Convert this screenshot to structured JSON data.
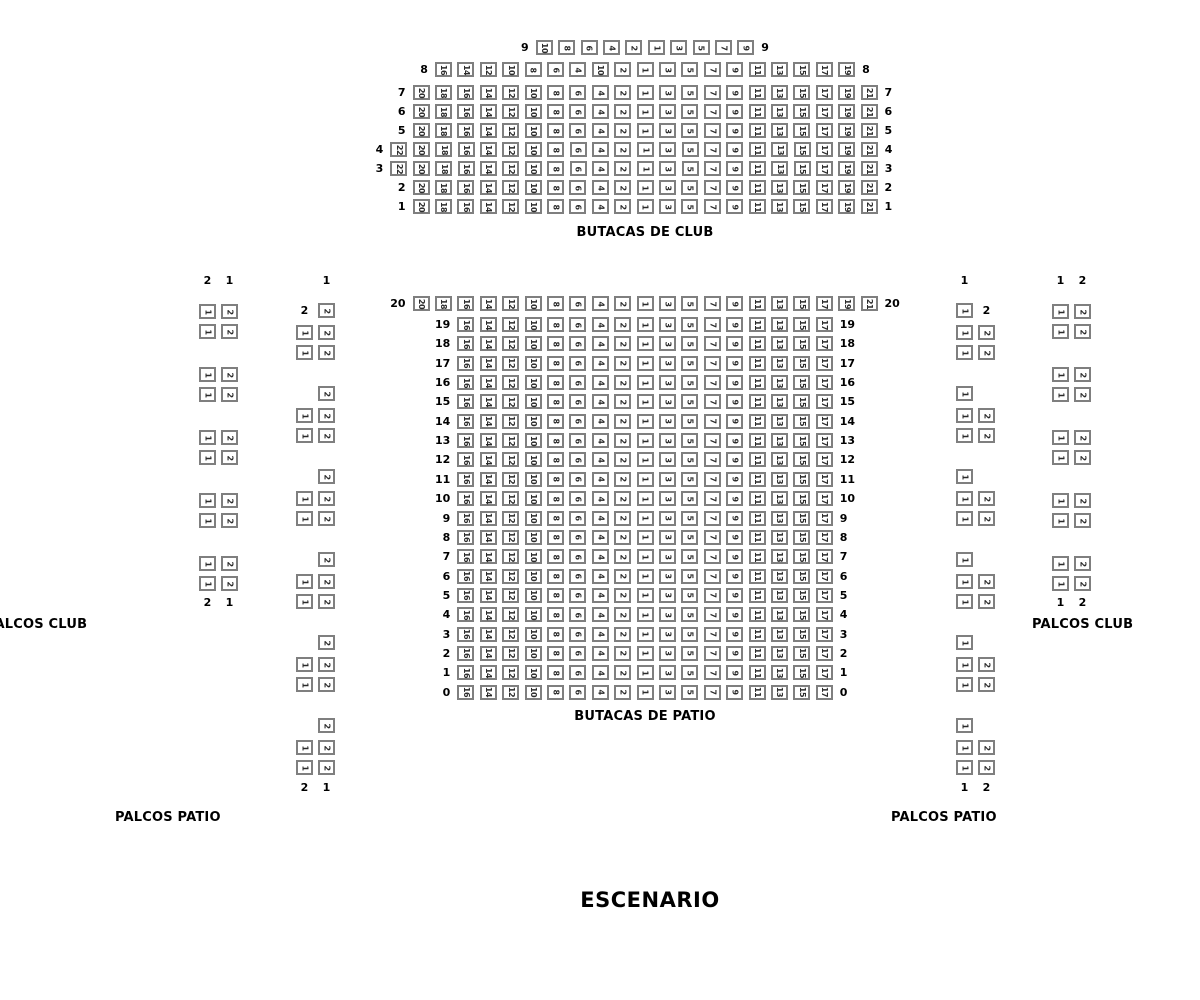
{
  "stage": {
    "label": "ESCENARIO"
  },
  "colors": {
    "seat_border": "#7f7f7f",
    "seat_number": "#2b2b2b",
    "label_text": "#000000"
  },
  "sections": {
    "club": {
      "title": "BUTACAS DE CLUB",
      "rows": [
        {
          "label": "9",
          "seats": [
            "10",
            "8",
            "6",
            "4",
            "2",
            "1",
            "3",
            "5",
            "7",
            "9"
          ]
        },
        {
          "label": "8",
          "seats": [
            "16",
            "14",
            "12",
            "10",
            "8",
            "6",
            "4",
            "10",
            "2",
            "1",
            "3",
            "5",
            "7",
            "9",
            "11",
            "13",
            "15",
            "17",
            "19"
          ]
        },
        {
          "label": "7",
          "seats": [
            "20",
            "18",
            "16",
            "14",
            "12",
            "10",
            "8",
            "6",
            "4",
            "2",
            "1",
            "3",
            "5",
            "7",
            "9",
            "11",
            "13",
            "15",
            "17",
            "19",
            "21"
          ]
        },
        {
          "label": "6",
          "seats": [
            "20",
            "18",
            "16",
            "14",
            "12",
            "10",
            "8",
            "6",
            "4",
            "2",
            "1",
            "3",
            "5",
            "7",
            "9",
            "11",
            "13",
            "15",
            "17",
            "19",
            "21"
          ]
        },
        {
          "label": "5",
          "seats": [
            "20",
            "18",
            "16",
            "14",
            "12",
            "10",
            "8",
            "6",
            "4",
            "2",
            "1",
            "3",
            "5",
            "7",
            "9",
            "11",
            "13",
            "15",
            "17",
            "19",
            "21"
          ]
        },
        {
          "label": "4",
          "seats": [
            "22",
            "20",
            "18",
            "16",
            "14",
            "12",
            "10",
            "8",
            "6",
            "4",
            "2",
            "1",
            "3",
            "5",
            "7",
            "9",
            "11",
            "13",
            "15",
            "17",
            "19",
            "21"
          ]
        },
        {
          "label": "3",
          "seats": [
            "22",
            "20",
            "18",
            "16",
            "14",
            "12",
            "10",
            "8",
            "6",
            "4",
            "2",
            "1",
            "3",
            "5",
            "7",
            "9",
            "11",
            "13",
            "15",
            "17",
            "19",
            "21"
          ]
        },
        {
          "label": "2",
          "seats": [
            "20",
            "18",
            "16",
            "14",
            "12",
            "10",
            "8",
            "6",
            "4",
            "2",
            "1",
            "3",
            "5",
            "7",
            "9",
            "11",
            "13",
            "15",
            "17",
            "19",
            "21"
          ]
        },
        {
          "label": "1",
          "seats": [
            "20",
            "18",
            "16",
            "14",
            "12",
            "10",
            "8",
            "6",
            "4",
            "2",
            "1",
            "3",
            "5",
            "7",
            "9",
            "11",
            "13",
            "15",
            "17",
            "19",
            "21"
          ]
        }
      ]
    },
    "patio": {
      "title": "BUTACAS DE PATIO",
      "rows": [
        {
          "label": "20",
          "seats": [
            "20",
            "18",
            "16",
            "14",
            "12",
            "10",
            "8",
            "6",
            "4",
            "2",
            "1",
            "3",
            "5",
            "7",
            "9",
            "11",
            "13",
            "15",
            "17",
            "19",
            "21"
          ]
        },
        {
          "label": "19",
          "seats": [
            "16",
            "14",
            "12",
            "10",
            "8",
            "6",
            "4",
            "2",
            "1",
            "3",
            "5",
            "7",
            "9",
            "11",
            "13",
            "15",
            "17"
          ]
        },
        {
          "label": "18",
          "seats": [
            "16",
            "14",
            "12",
            "10",
            "8",
            "6",
            "4",
            "2",
            "1",
            "3",
            "5",
            "7",
            "9",
            "11",
            "13",
            "15",
            "17"
          ]
        },
        {
          "label": "17",
          "seats": [
            "16",
            "14",
            "12",
            "10",
            "8",
            "6",
            "4",
            "2",
            "1",
            "3",
            "5",
            "7",
            "9",
            "11",
            "13",
            "15",
            "17"
          ]
        },
        {
          "label": "16",
          "seats": [
            "16",
            "14",
            "12",
            "10",
            "8",
            "6",
            "4",
            "2",
            "1",
            "3",
            "5",
            "7",
            "9",
            "11",
            "13",
            "15",
            "17"
          ]
        },
        {
          "label": "15",
          "seats": [
            "16",
            "14",
            "12",
            "10",
            "8",
            "6",
            "4",
            "2",
            "1",
            "3",
            "5",
            "7",
            "9",
            "11",
            "13",
            "15",
            "17"
          ]
        },
        {
          "label": "14",
          "seats": [
            "16",
            "14",
            "12",
            "10",
            "8",
            "6",
            "4",
            "2",
            "1",
            "3",
            "5",
            "7",
            "9",
            "11",
            "13",
            "15",
            "17"
          ]
        },
        {
          "label": "13",
          "seats": [
            "16",
            "14",
            "12",
            "10",
            "8",
            "6",
            "4",
            "2",
            "1",
            "3",
            "5",
            "7",
            "9",
            "11",
            "13",
            "15",
            "17"
          ]
        },
        {
          "label": "12",
          "seats": [
            "16",
            "14",
            "12",
            "10",
            "8",
            "6",
            "4",
            "2",
            "1",
            "3",
            "5",
            "7",
            "9",
            "11",
            "13",
            "15",
            "17"
          ]
        },
        {
          "label": "11",
          "seats": [
            "16",
            "14",
            "12",
            "10",
            "8",
            "6",
            "4",
            "2",
            "1",
            "3",
            "5",
            "7",
            "9",
            "11",
            "13",
            "15",
            "17"
          ]
        },
        {
          "label": "10",
          "seats": [
            "16",
            "14",
            "12",
            "10",
            "8",
            "6",
            "4",
            "2",
            "1",
            "3",
            "5",
            "7",
            "9",
            "11",
            "13",
            "15",
            "17"
          ]
        },
        {
          "label": "9",
          "seats": [
            "16",
            "14",
            "12",
            "10",
            "8",
            "6",
            "4",
            "2",
            "1",
            "3",
            "5",
            "7",
            "9",
            "11",
            "13",
            "15",
            "17"
          ]
        },
        {
          "label": "8",
          "seats": [
            "16",
            "14",
            "12",
            "10",
            "8",
            "6",
            "4",
            "2",
            "1",
            "3",
            "5",
            "7",
            "9",
            "11",
            "13",
            "15",
            "17"
          ]
        },
        {
          "label": "7",
          "seats": [
            "16",
            "14",
            "12",
            "10",
            "8",
            "6",
            "4",
            "2",
            "1",
            "3",
            "5",
            "7",
            "9",
            "11",
            "13",
            "15",
            "17"
          ]
        },
        {
          "label": "6",
          "seats": [
            "16",
            "14",
            "12",
            "10",
            "8",
            "6",
            "4",
            "2",
            "1",
            "3",
            "5",
            "7",
            "9",
            "11",
            "13",
            "15",
            "17"
          ]
        },
        {
          "label": "5",
          "seats": [
            "16",
            "14",
            "12",
            "10",
            "8",
            "6",
            "4",
            "2",
            "1",
            "3",
            "5",
            "7",
            "9",
            "11",
            "13",
            "15",
            "17"
          ]
        },
        {
          "label": "4",
          "seats": [
            "16",
            "14",
            "12",
            "10",
            "8",
            "6",
            "4",
            "2",
            "1",
            "3",
            "5",
            "7",
            "9",
            "11",
            "13",
            "15",
            "17"
          ]
        },
        {
          "label": "3",
          "seats": [
            "16",
            "14",
            "12",
            "10",
            "8",
            "6",
            "4",
            "2",
            "1",
            "3",
            "5",
            "7",
            "9",
            "11",
            "13",
            "15",
            "17"
          ]
        },
        {
          "label": "2",
          "seats": [
            "16",
            "14",
            "12",
            "10",
            "8",
            "6",
            "4",
            "2",
            "1",
            "3",
            "5",
            "7",
            "9",
            "11",
            "13",
            "15",
            "17"
          ]
        },
        {
          "label": "1",
          "seats": [
            "16",
            "14",
            "12",
            "10",
            "8",
            "6",
            "4",
            "2",
            "1",
            "3",
            "5",
            "7",
            "9",
            "11",
            "13",
            "15",
            "17"
          ]
        },
        {
          "label": "0",
          "seats": [
            "16",
            "14",
            "12",
            "10",
            "8",
            "6",
            "4",
            "2",
            "1",
            "3",
            "5",
            "7",
            "9",
            "11",
            "13",
            "15",
            "17"
          ]
        }
      ]
    }
  },
  "palcos": {
    "left_club": {
      "label": "PALCOS CLUB",
      "header": [
        "2",
        "1"
      ],
      "footer": [
        "2",
        "1"
      ],
      "groups": [
        [
          [
            "1",
            "2"
          ],
          [
            "1",
            "2"
          ]
        ],
        [
          [
            "1",
            "2"
          ],
          [
            "1",
            "2"
          ]
        ],
        [
          [
            "1",
            "2"
          ],
          [
            "1",
            "2"
          ]
        ],
        [
          [
            "1",
            "2"
          ],
          [
            "1",
            "2"
          ]
        ],
        [
          [
            "1",
            "2"
          ],
          [
            "1",
            "2"
          ]
        ]
      ]
    },
    "left_patio": {
      "label": "PALCOS PATIO",
      "header": [
        "",
        "1"
      ],
      "footer": [
        "2",
        "1"
      ],
      "groups": [
        [
          [
            "#2",
            "2"
          ],
          [
            "1",
            "2"
          ],
          [
            "1",
            "2"
          ]
        ],
        [
          [
            "",
            "2"
          ],
          [
            "1",
            "2"
          ],
          [
            "1",
            "2"
          ]
        ],
        [
          [
            "",
            "2"
          ],
          [
            "1",
            "2"
          ],
          [
            "1",
            "2"
          ]
        ],
        [
          [
            "",
            "2"
          ],
          [
            "1",
            "2"
          ],
          [
            "1",
            "2"
          ]
        ],
        [
          [
            "",
            "2"
          ],
          [
            "1",
            "2"
          ],
          [
            "1",
            "2"
          ]
        ],
        [
          [
            "",
            "2"
          ],
          [
            "1",
            "2"
          ],
          [
            "1",
            "2"
          ]
        ]
      ]
    },
    "right_patio": {
      "label": "PALCOS PATIO",
      "header": [
        "1",
        ""
      ],
      "footer": [
        "1",
        "2"
      ],
      "groups": [
        [
          [
            "1",
            "#2"
          ],
          [
            "1",
            "2"
          ],
          [
            "1",
            "2"
          ]
        ],
        [
          [
            "1",
            ""
          ],
          [
            "1",
            "2"
          ],
          [
            "1",
            "2"
          ]
        ],
        [
          [
            "1",
            ""
          ],
          [
            "1",
            "2"
          ],
          [
            "1",
            "2"
          ]
        ],
        [
          [
            "1",
            ""
          ],
          [
            "1",
            "2"
          ],
          [
            "1",
            "2"
          ]
        ],
        [
          [
            "1",
            ""
          ],
          [
            "1",
            "2"
          ],
          [
            "1",
            "2"
          ]
        ],
        [
          [
            "1",
            ""
          ],
          [
            "1",
            "2"
          ],
          [
            "1",
            "2"
          ]
        ]
      ]
    },
    "right_club": {
      "label": "PALCOS CLUB",
      "header": [
        "1",
        "2"
      ],
      "footer": [
        "1",
        "2"
      ],
      "groups": [
        [
          [
            "1",
            "2"
          ],
          [
            "1",
            "2"
          ]
        ],
        [
          [
            "1",
            "2"
          ],
          [
            "1",
            "2"
          ]
        ],
        [
          [
            "1",
            "2"
          ],
          [
            "1",
            "2"
          ]
        ],
        [
          [
            "1",
            "2"
          ],
          [
            "1",
            "2"
          ]
        ],
        [
          [
            "1",
            "2"
          ],
          [
            "1",
            "2"
          ]
        ]
      ]
    }
  }
}
